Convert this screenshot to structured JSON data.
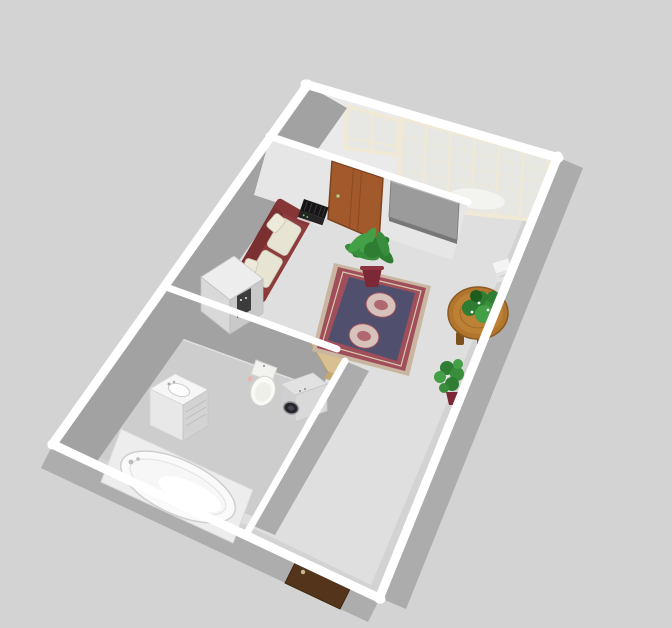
{
  "view": {
    "app": "home-design-3d-viewport",
    "mode": "aerial-3d-view"
  },
  "palette": {
    "background": "#D3D3D3",
    "floor": "#DFDFDF",
    "bathroom_floor": "#CDCDCD",
    "wall_top": "#FFFFFF",
    "wall_lit": "#EAEAEA",
    "wall_partition": "#E6E6E6",
    "wall_shadow": "#A2A2A2",
    "wall_outer": "#ACACAC",
    "window_frame": "#EFE9D6",
    "window_glass": "#E7E7E3",
    "interior_door": "#A2592B",
    "entry_door": "#54351B",
    "open_door_wood": "#D9C093",
    "tv_panel": "#9B9B9B",
    "curtain_white": "#F3F3F0",
    "sofa": "#8E3B3C",
    "sofa_back": "#7A2F30",
    "sofa_cushion": "#E8E4D4",
    "rug_edge": "#C9B5A0",
    "rug_border": "#A04F5A",
    "rug_field": "#50506E",
    "rug_medallion": "#D6C2BA",
    "table_wood": "#B1752E",
    "plant_green": "#2E7D32",
    "plant_green_light": "#43A047",
    "plant_pot": "#7C2836",
    "stereo_black": "#151515",
    "appliance_gray": "#D9D9D9",
    "appliance_dark_panel": "#3C3C3C",
    "washer_door": "#26262B",
    "fixture_white": "#FAFAFA"
  },
  "scene": {
    "rooms": [
      {
        "name": "living-room",
        "items": [
          "sofa",
          "stereo",
          "refrigerator",
          "area-rug",
          "round-table",
          "table-plant",
          "potted-palm",
          "potted-fern",
          "tv-panel",
          "interior-door",
          "wall-heater"
        ]
      },
      {
        "name": "bathroom",
        "items": [
          "bathtub",
          "vanity-sink",
          "toilet",
          "washing-machine",
          "open-wood-door"
        ]
      },
      {
        "name": "balcony-strip",
        "items": [
          "casement-window",
          "panel-window"
        ]
      }
    ],
    "exterior_items": [
      "entry-door"
    ]
  }
}
